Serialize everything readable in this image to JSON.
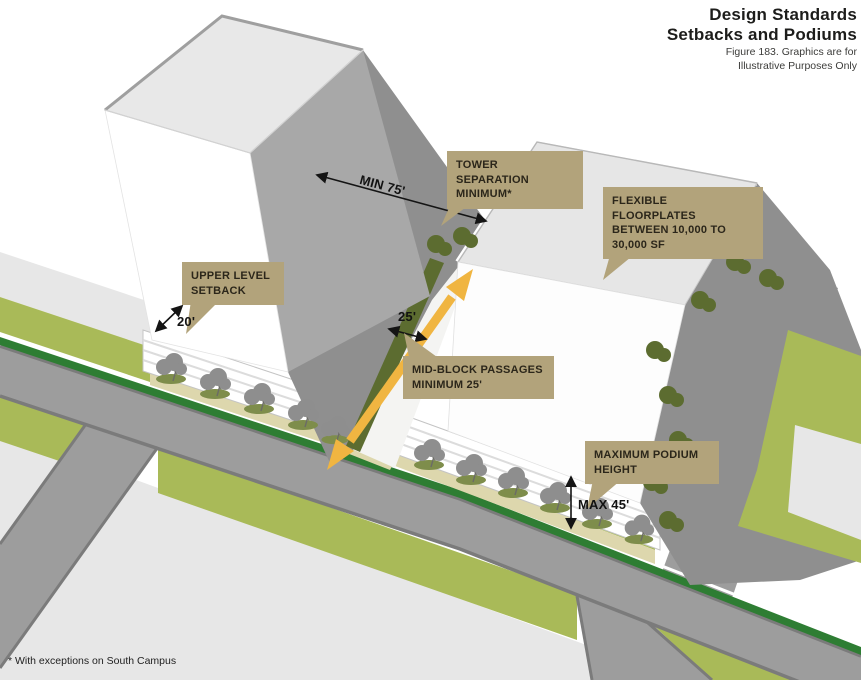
{
  "header": {
    "title_line1": "Design Standards",
    "title_line2": "Setbacks and Podiums",
    "caption_line1": "Figure 183. Graphics are for",
    "caption_line2": "Illustrative Purposes Only"
  },
  "callouts": {
    "tower_separation": "TOWER SEPARATION MINIMUM*",
    "flexible_floorplates": "FLEXIBLE FLOORPLATES BETWEEN 10,000 TO 30,000 SF",
    "upper_level_setback": "UPPER LEVEL SETBACK",
    "mid_block_passages": "MID-BLOCK PASSAGES MINIMUM 25'",
    "maximum_podium_height": "MAXIMUM PODIUM HEIGHT"
  },
  "dimensions": {
    "tower_separation_min": "MIN 75'",
    "upper_level_setback": "20'",
    "mid_block_passage": "25'",
    "max_podium_height": "MAX 45'"
  },
  "footnote": "* With exceptions on South Campus",
  "colors": {
    "ink": "#1d1d1b",
    "callout_bg": "#b2a37b",
    "callout_text": "#2b261a",
    "green_light": "#a9ba58",
    "green_dark": "#2e7d33",
    "olive": "#7e8d4b",
    "olive_dark": "#5c6c30",
    "road": "#9d9d9d",
    "road_edge": "#7b7b7b",
    "shadow": "#8f8f8f",
    "plaza": "#e7e7e7",
    "beige": "#ddd7ad",
    "yellow": "#f0b541",
    "tower_side": "#a8a8a8",
    "roof": "#e8e8e8",
    "tree_gray": "#8e8e8e"
  }
}
